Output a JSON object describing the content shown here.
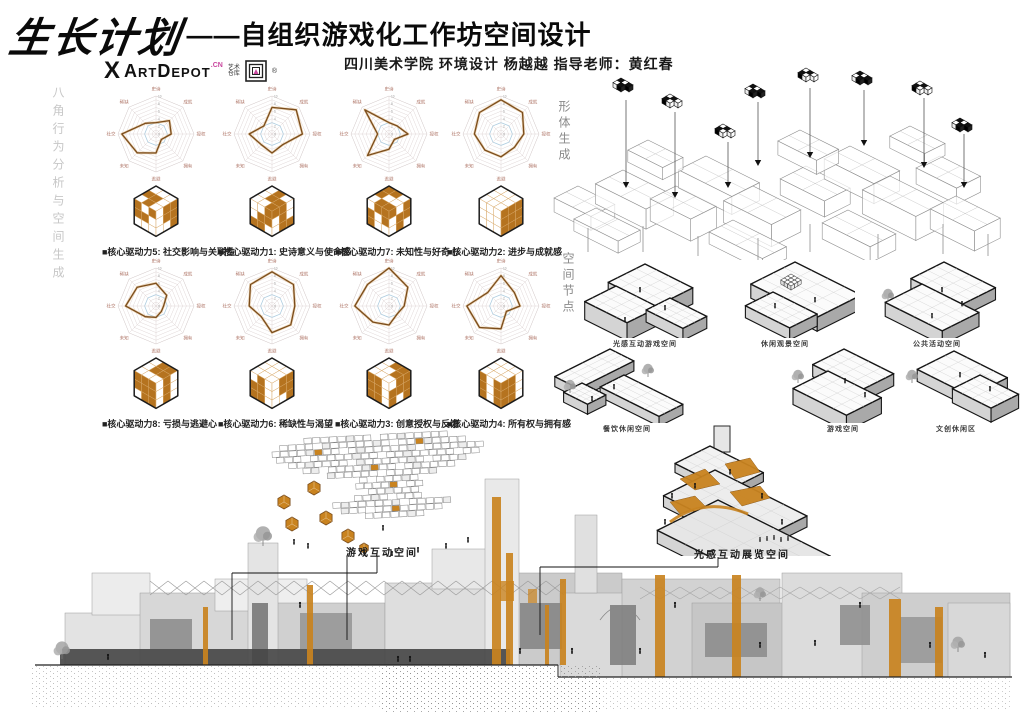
{
  "poster": {
    "title_main": "生长计划",
    "title_sub": "——自组织游戏化工作坊空间设计",
    "credit": "四川美术学院 环境设计 杨越越 指导老师：黄红春",
    "logo": {
      "x": "X",
      "name": "ArtDepot",
      "cn": ".CN",
      "tagline1": "艺术",
      "tagline2": "仓库",
      "reg": "®"
    }
  },
  "section_labels": {
    "left_vertical": "八角行为分析与空间生成",
    "form_vertical": "形体生成",
    "node_vertical": "空间节点"
  },
  "space_nodes": {
    "items": [
      {
        "label": "光感互动游戏空间"
      },
      {
        "label": "休闲观景空间"
      },
      {
        "label": "公共活动空间"
      },
      {
        "label": "餐饮休闲空间"
      },
      {
        "label": "游戏空间"
      },
      {
        "label": "文创休闲区"
      }
    ]
  },
  "callouts": {
    "game": "游戏互动空间",
    "light": "光感互动展览空间"
  },
  "colors": {
    "accent": "#c9831f",
    "cube_orange": "#b5731f",
    "radar_stroke": "#7a4c1c",
    "radar_soft": "#d9a75f",
    "radar_grid": "#ddd2d2",
    "radar_blue": "#aecde0",
    "radar_label": "#b0786a",
    "logo_pink": "#c9479e",
    "muted": "#9a9a9a"
  },
  "chart_data": [
    {
      "type": "radar",
      "title": "■核心驱动力5: 社交影响与关联性",
      "axes": [
        "史诗",
        "成就",
        "授权",
        "拥有",
        "逃避",
        "未知",
        "社交",
        "稀缺"
      ],
      "max": 10,
      "ticks": [
        0,
        2,
        4,
        6,
        8,
        10
      ],
      "values": [
        3,
        5,
        4,
        2,
        5,
        7,
        9,
        4
      ],
      "cube": {
        "top": "000110010",
        "left": "101110000",
        "right": "011011001"
      }
    },
    {
      "type": "radar",
      "title": "■核心驱动力1: 史诗意义与使命感",
      "axes": [
        "史诗",
        "成就",
        "授权",
        "拥有",
        "逃避",
        "未知",
        "社交",
        "稀缺"
      ],
      "max": 10,
      "ticks": [
        0,
        2,
        4,
        6,
        8,
        10
      ],
      "values": [
        7,
        9,
        8,
        4,
        5,
        4,
        6,
        3
      ],
      "cube": {
        "top": "010011001",
        "left": "001011110",
        "right": "110010011"
      }
    },
    {
      "type": "radar",
      "title": "■核心驱动力7: 未知性与好奇心",
      "axes": [
        "史诗",
        "成就",
        "授权",
        "拥有",
        "逃避",
        "未知",
        "社交",
        "稀缺"
      ],
      "max": 10,
      "ticks": [
        0,
        2,
        4,
        6,
        8,
        10
      ],
      "values": [
        3,
        3,
        5,
        2,
        4,
        8,
        3,
        9
      ],
      "cube": {
        "top": "110100011",
        "left": "011101100",
        "right": "101011010"
      }
    },
    {
      "type": "radar",
      "title": "■核心驱动力2: 进步与成就感",
      "axes": [
        "史诗",
        "成就",
        "授权",
        "拥有",
        "逃避",
        "未知",
        "社交",
        "稀缺"
      ],
      "max": 10,
      "ticks": [
        0,
        2,
        4,
        6,
        8,
        10
      ],
      "values": [
        9,
        8,
        6,
        5,
        6,
        6,
        7,
        8
      ],
      "cube": {
        "top": "000000000",
        "left": "000000000",
        "right": "111111111"
      }
    },
    {
      "type": "radar",
      "title": "■核心驱动力8: 亏损与逃避心",
      "axes": [
        "史诗",
        "成就",
        "授权",
        "拥有",
        "逃避",
        "未知",
        "社交",
        "稀缺"
      ],
      "max": 10,
      "ticks": [
        0,
        2,
        4,
        6,
        8,
        10
      ],
      "values": [
        6,
        4,
        2,
        2,
        3,
        4,
        8,
        7
      ],
      "cube": {
        "top": "011011000",
        "left": "111111011",
        "right": "010010010"
      }
    },
    {
      "type": "radar",
      "title": "■核心驱动力6: 稀缺性与渴望",
      "axes": [
        "史诗",
        "成就",
        "授权",
        "拥有",
        "逃避",
        "未知",
        "社交",
        "稀缺"
      ],
      "max": 10,
      "ticks": [
        0,
        2,
        4,
        6,
        8,
        10
      ],
      "values": [
        9,
        8,
        6,
        7,
        7,
        4,
        6,
        8
      ],
      "cube": {
        "top": "000000000",
        "left": "010110110",
        "right": "011011001"
      }
    },
    {
      "type": "radar",
      "title": "■核心驱动力3: 创意授权与反馈",
      "axes": [
        "史诗",
        "成就",
        "授权",
        "拥有",
        "逃避",
        "未知",
        "社交",
        "稀缺"
      ],
      "max": 10,
      "ticks": [
        0,
        2,
        4,
        6,
        8,
        10
      ],
      "values": [
        10,
        7,
        4,
        3,
        5,
        6,
        9,
        8
      ],
      "cube": {
        "top": "011001000",
        "left": "110110110",
        "right": "011111101"
      }
    },
    {
      "type": "radar",
      "title": "■核心驱动力4: 所有权与拥有感",
      "axes": [
        "史诗",
        "成就",
        "授权",
        "拥有",
        "逃避",
        "未知",
        "社交",
        "稀缺"
      ],
      "max": 10,
      "ticks": [
        0,
        2,
        4,
        6,
        8,
        10
      ],
      "values": [
        8,
        5,
        5,
        2,
        6,
        8,
        9,
        5
      ],
      "cube": {
        "top": "000000000",
        "left": "101101101",
        "right": "110110110"
      }
    }
  ]
}
